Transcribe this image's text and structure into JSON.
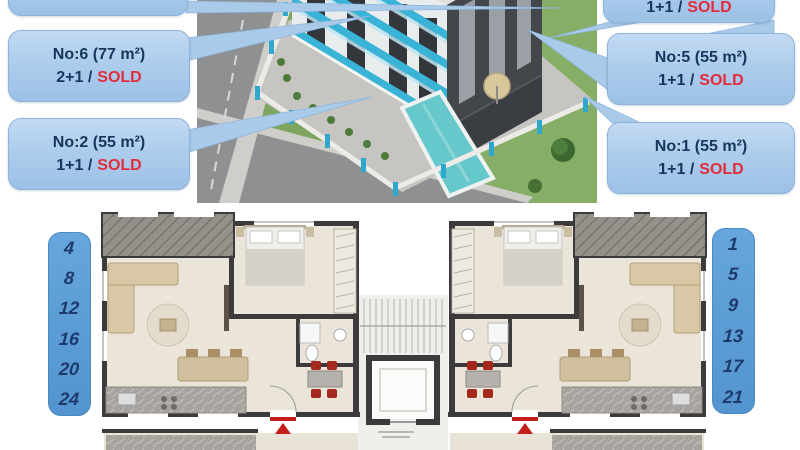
{
  "callouts": {
    "top_left": {
      "note": ""
    },
    "no6": {
      "title": "No:6 (77 m²)",
      "type": "2+1 /",
      "status": "SOLD"
    },
    "no2": {
      "title": "No:2 (55 m²)",
      "type": "1+1 /",
      "status": "SOLD"
    },
    "top_right": {
      "type": "1+1 /",
      "status": "SOLD"
    },
    "no5": {
      "title": "No:5 (55 m²)",
      "type": "1+1 /",
      "status": "SOLD"
    },
    "no1": {
      "title": "No:1 (55 m²)",
      "type": "1+1 /",
      "status": "SOLD"
    }
  },
  "floor_chips": {
    "left": [
      "4",
      "8",
      "12",
      "16",
      "20",
      "24"
    ],
    "right": [
      "1",
      "5",
      "9",
      "13",
      "17",
      "21"
    ]
  },
  "colors": {
    "callout_blue": "#aecdec",
    "callout_border": "#8db3dc",
    "navy_text": "#17365d",
    "sold_red": "#e32b3c",
    "chip_blue": "#5b9bd5",
    "chip_text": "#1d3a6b",
    "plan_wall": "#3c3a3b",
    "plan_floor": "#eae4d9",
    "balcony_grey": "#94908a",
    "entrance_red": "#c21f1a",
    "building_cyan": "#39b3d6",
    "pool_turquoise": "#67c8cb",
    "lawn_green": "#7da55e",
    "road_grey": "#8f9092"
  }
}
